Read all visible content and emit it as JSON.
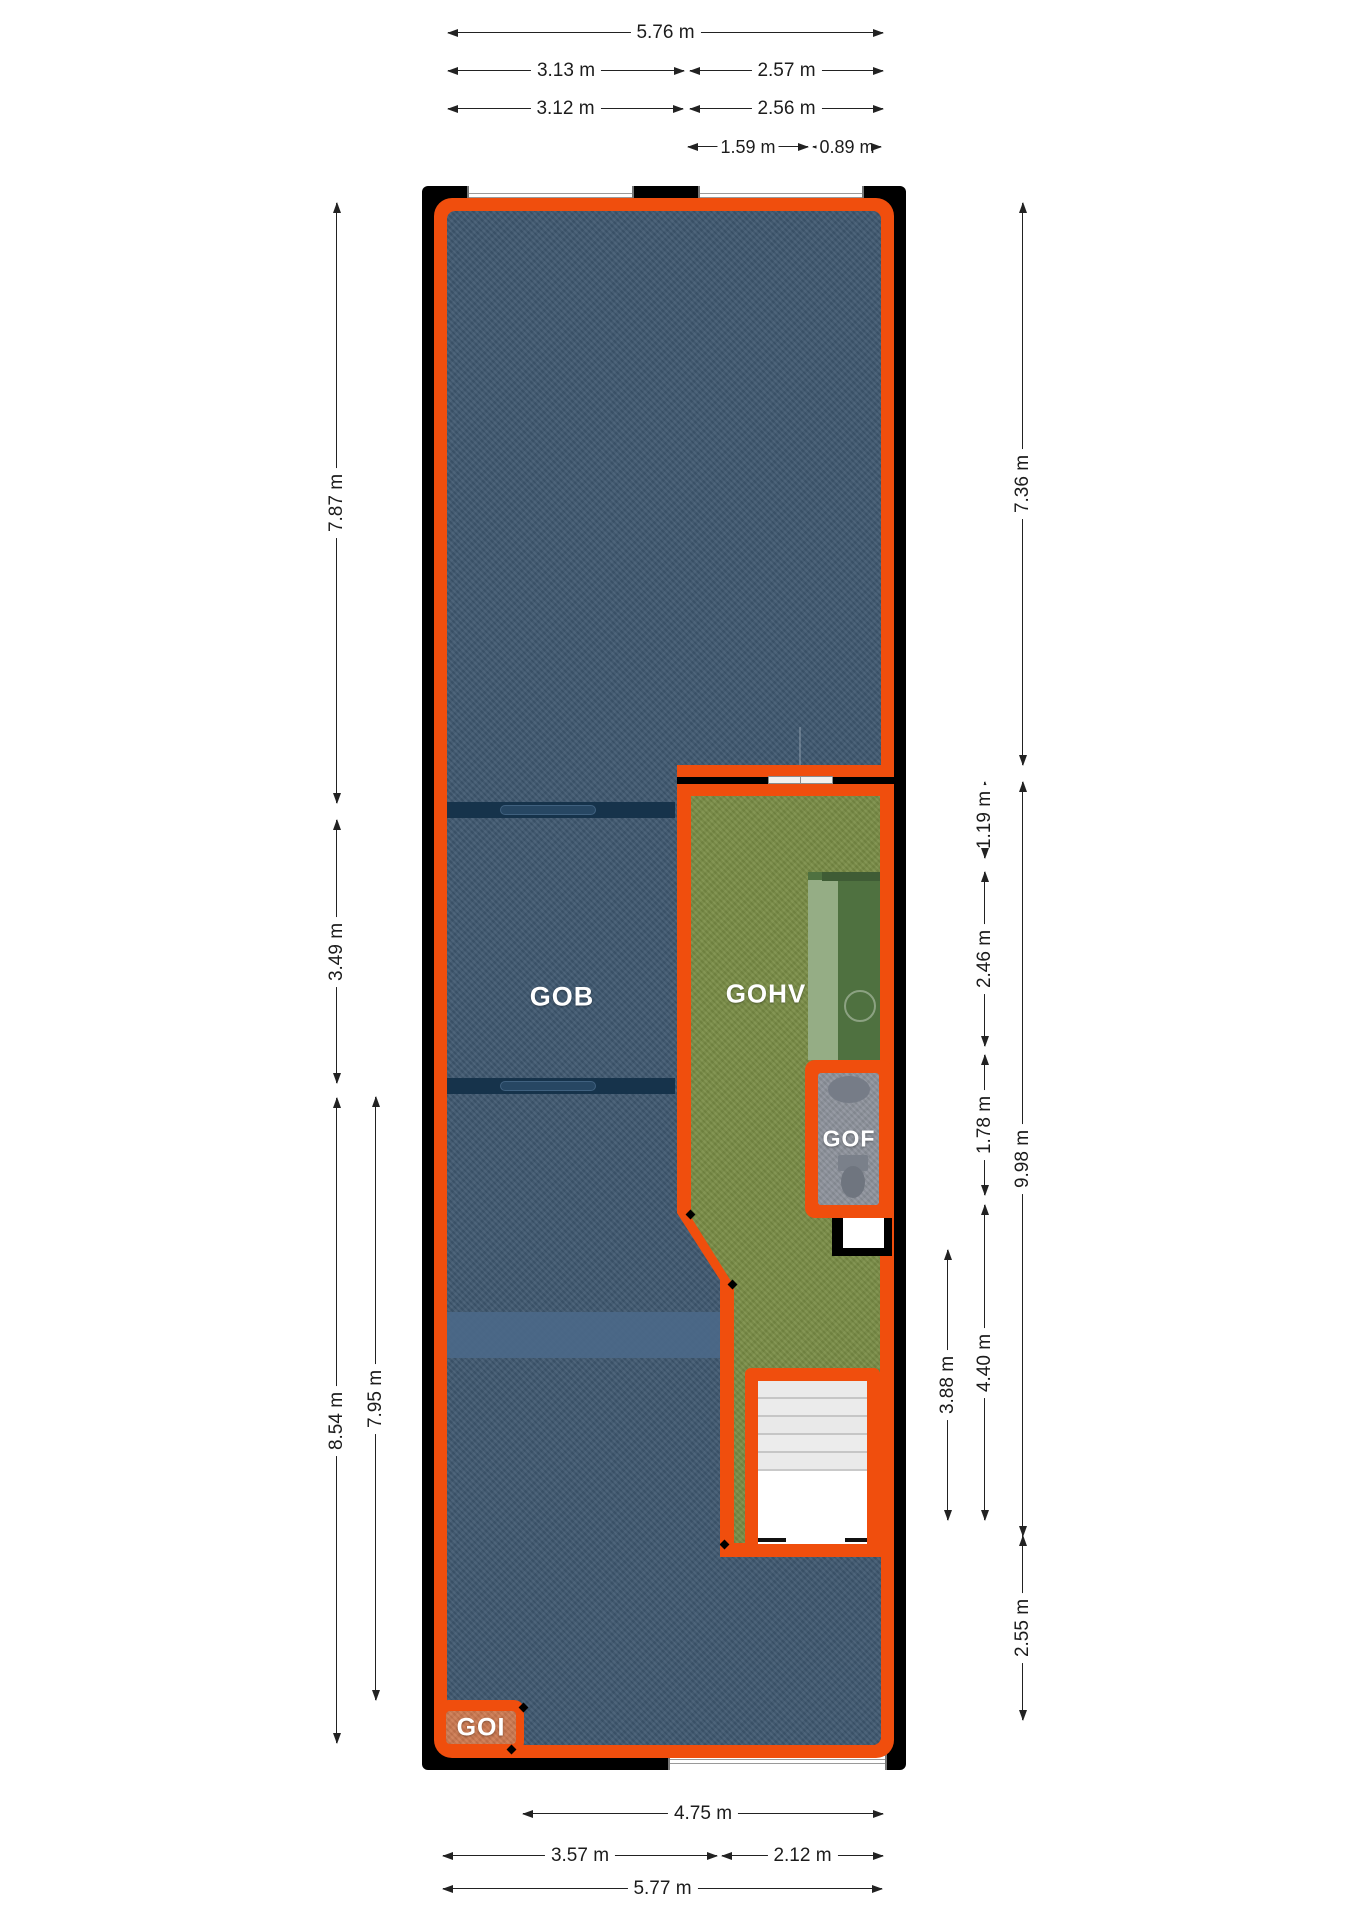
{
  "plan": {
    "type": "floor-plan",
    "rooms": {
      "gob": {
        "label": "GOB",
        "floor_color": "#3f5870"
      },
      "gohv": {
        "label": "GOHV",
        "floor_color": "#798c45"
      },
      "gof": {
        "label": "GOF",
        "floor_color": "#8e939c"
      },
      "goi": {
        "label": "GOI",
        "badge_color": "#f04e0d"
      }
    },
    "colors": {
      "wall": "#000000",
      "outline_orange": "#f04e0d",
      "gob_floor": "#3f5870",
      "gob_light_band": "#4b6888",
      "partition_dark": "#16334b",
      "gohv_floor": "#798c45",
      "kitchen_counter_dark": "#4f7140",
      "kitchen_counter_light": "#9cb48d",
      "gof_floor": "#8e939c",
      "stair_tread": "#eaeaea",
      "window_white": "#ffffff"
    },
    "fixtures": [
      "window",
      "window",
      "window",
      "interior-window",
      "kitchen-counter",
      "sink",
      "washbasin",
      "toilet",
      "staircase",
      "entry-niche"
    ]
  },
  "dimensions": {
    "top": [
      "5.76 m",
      "3.13 m",
      "2.57 m",
      "3.12 m",
      "2.56 m",
      "1.59 m",
      "0.89 m"
    ],
    "left": [
      "7.87 m",
      "3.49 m",
      "8.54 m",
      "7.95 m"
    ],
    "right": [
      "7.36 m",
      "1.19 m",
      "2.46 m",
      "1.78 m",
      "9.98 m",
      "3.88 m",
      "4.40 m",
      "2.55 m"
    ],
    "bottom": [
      "4.75 m",
      "3.57 m",
      "2.12 m",
      "5.77 m"
    ]
  }
}
